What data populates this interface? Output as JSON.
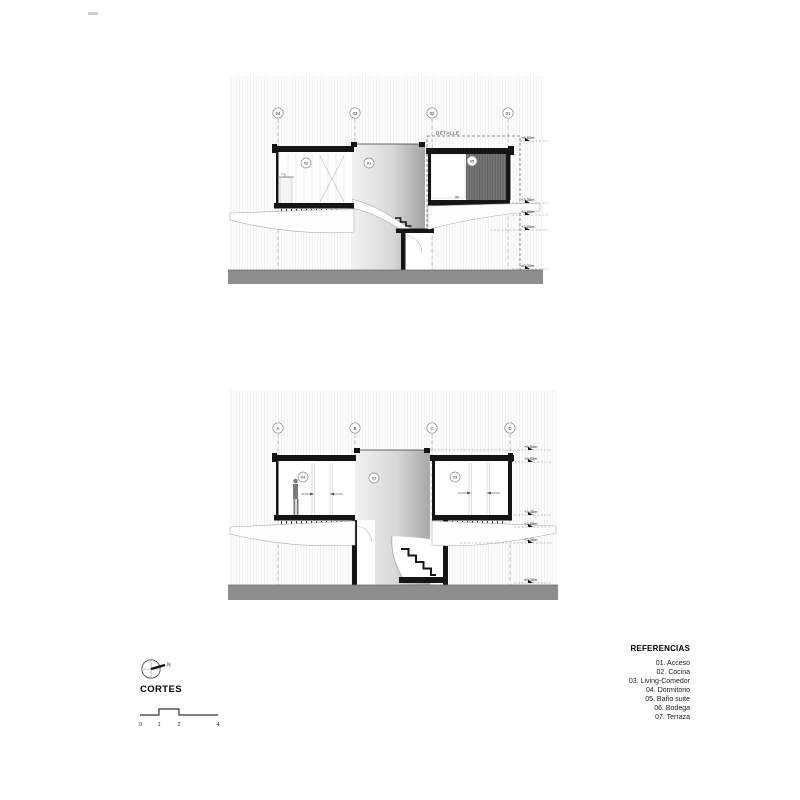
{
  "legend": {
    "title": "REFERENCIAS",
    "items": [
      "01. Acceso",
      "02. Cocina",
      "03. Living-Comedor",
      "04. Dormitorio",
      "05. Baño suite",
      "06. Bodega",
      "07. Terraza"
    ]
  },
  "title_block": {
    "title": "CORTES",
    "north_label": "N",
    "scale_numbers": [
      "0",
      "1",
      "2",
      "4"
    ]
  },
  "section_top": {
    "grid_labels": [
      "04",
      "03",
      "02",
      "01"
    ],
    "detail_label": "DETALLE",
    "window_label": "VF",
    "room_labels": {
      "left": "02",
      "center": "01",
      "right": "05"
    },
    "elevations": [
      "+6.50m",
      "+3.35m",
      "+2.80m",
      "+2.00m",
      "±0.00m"
    ]
  },
  "section_bottom": {
    "grid_labels": [
      "A",
      "B",
      "C",
      "D"
    ],
    "room_labels": {
      "left": "04",
      "center": "01",
      "right": "03"
    },
    "elevations": [
      "+6.50m",
      "+5.95m",
      "+3.35m",
      "+2.80m",
      "+2.00m",
      "±0.00m"
    ]
  },
  "colors": {
    "ground": "#8d8d8d",
    "wall": "#151515",
    "dark_panel": "#767676",
    "hatch_line": "#ececec"
  }
}
